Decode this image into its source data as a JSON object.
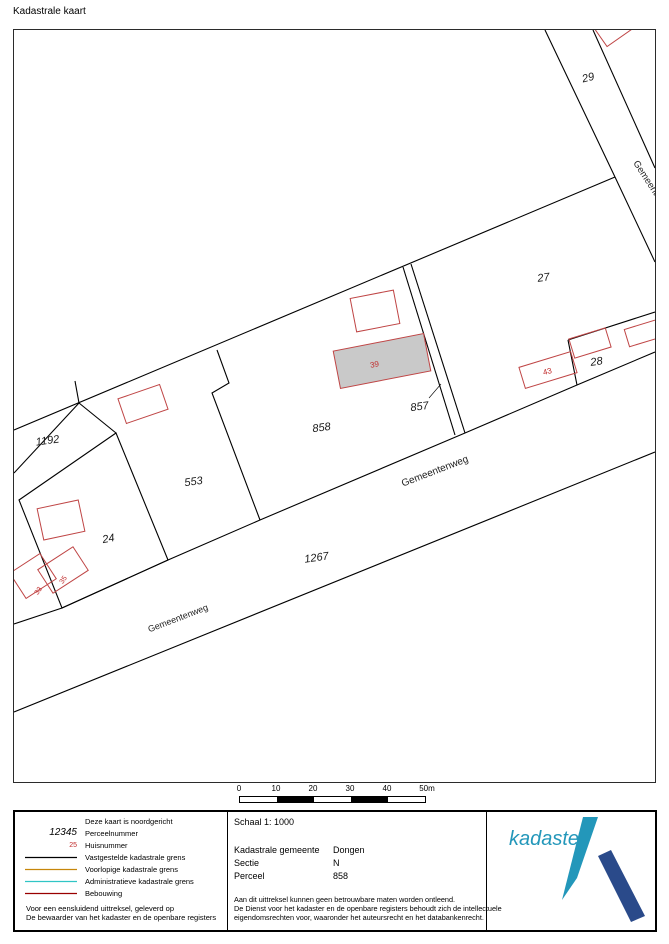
{
  "page": {
    "title": "Kadastrale kaart"
  },
  "map": {
    "colors": {
      "boundary": "#000000",
      "building_outline": "#bf4545",
      "building_fill": "#c9c9c9",
      "house_number": "#c02b2b",
      "label": "#1a1a1a"
    },
    "parcels": [
      {
        "label": "29"
      },
      {
        "label": "27"
      },
      {
        "label": "28"
      },
      {
        "label": "858"
      },
      {
        "label": "857"
      },
      {
        "label": "553"
      },
      {
        "label": "1192"
      },
      {
        "label": "24"
      },
      {
        "label": "1267"
      }
    ],
    "house_numbers": [
      {
        "label": "39"
      },
      {
        "label": "43"
      },
      {
        "label": "35"
      },
      {
        "label": "33"
      }
    ],
    "road_labels": [
      {
        "label": "Gemeentenweg"
      },
      {
        "label": "Gemeentenweg"
      },
      {
        "label": "Gemeente"
      }
    ],
    "scale_bar": {
      "ticks": [
        "0",
        "10",
        "20",
        "30",
        "40",
        "50m"
      ]
    }
  },
  "legend": {
    "rows": [
      {
        "label": "Deze kaart is noordgericht",
        "symbol_text": ""
      },
      {
        "label": "Perceelnummer",
        "symbol_text": "12345"
      },
      {
        "label": "Huisnummer",
        "symbol_text": "25"
      },
      {
        "label": "Vastgestelde kadastrale grens",
        "color": "#000000"
      },
      {
        "label": "Voorlopige kadastrale grens",
        "color": "#c6860a"
      },
      {
        "label": "Administratieve kadastrale grens",
        "color": "#30c5c5"
      },
      {
        "label": "Bebouwing",
        "color": "#990000"
      }
    ],
    "notes": [
      "Voor een eensluidend uittreksel, geleverd op",
      "De bewaarder van het kadaster en de openbare registers"
    ]
  },
  "info": {
    "schaal": "Schaal 1: 1000",
    "rows": [
      {
        "label": "Kadastrale gemeente",
        "value": "Dongen"
      },
      {
        "label": "Sectie",
        "value": "N"
      },
      {
        "label": "Perceel",
        "value": "858"
      }
    ],
    "disclaimer": [
      "Aan dit uittreksel kunnen geen betrouwbare maten worden ontleend.",
      "De Dienst voor het kadaster en de openbare registers behoudt zich de intellectuele",
      "eigendomsrechten voor, waaronder het auteursrecht en het databankenrecht."
    ]
  },
  "logo": {
    "text": "kadaster",
    "light_blue": "#2397ba",
    "dark_blue": "#2a4a8a"
  }
}
